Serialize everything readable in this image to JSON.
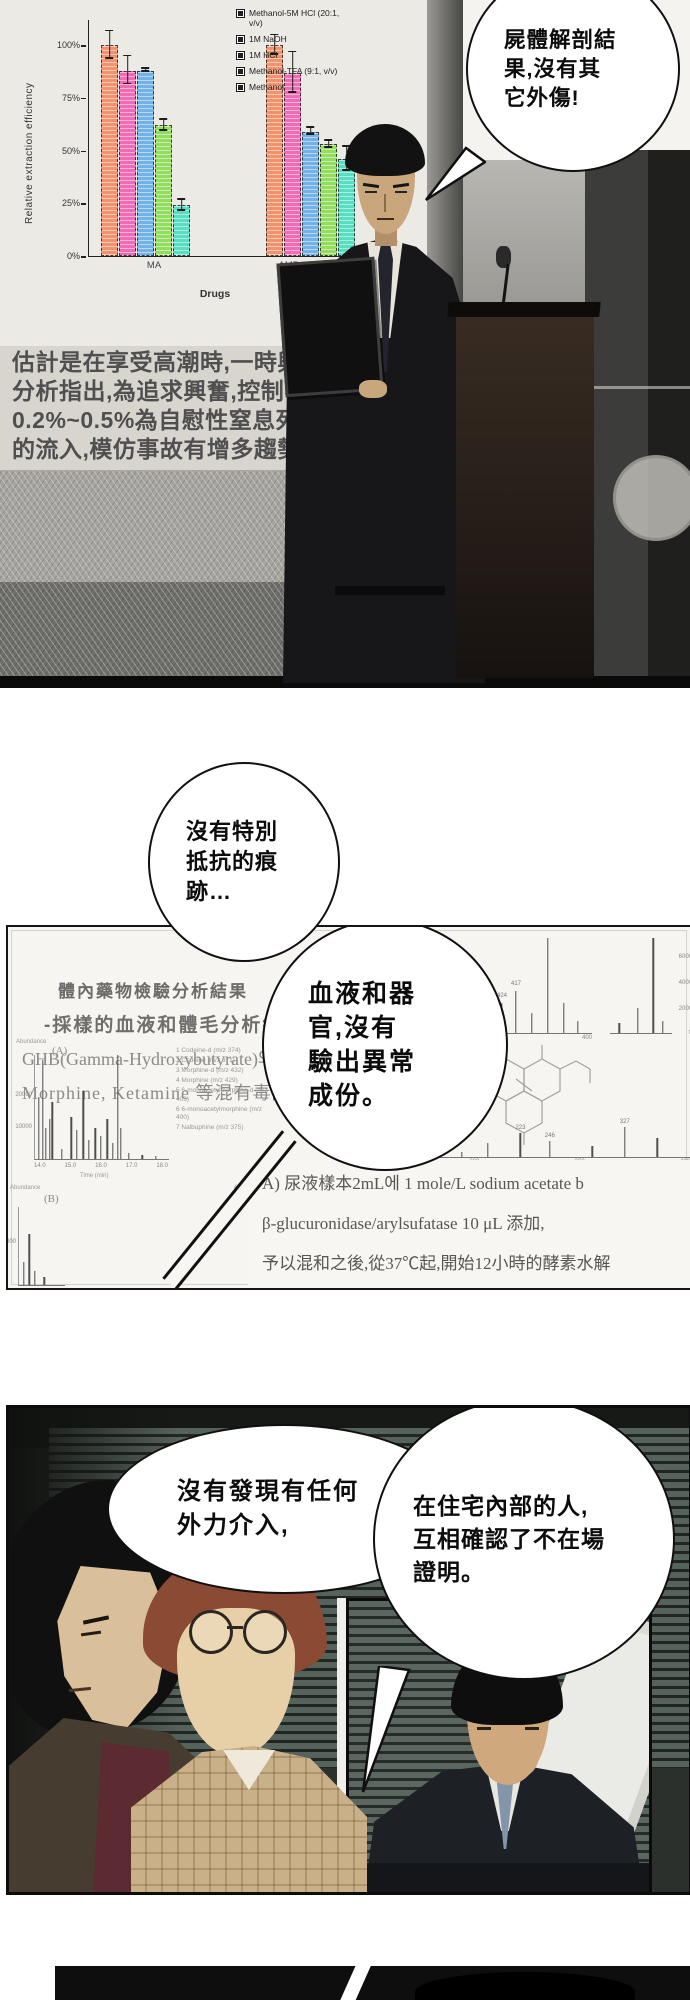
{
  "panel1": {
    "bubble_lines": [
      "屍體解剖結",
      "果,沒有其",
      "它外傷!"
    ],
    "caption_lines": [
      "估計是在享受高潮時,一時興奮而死,",
      "分析指出,為追求興奮,控制不當,導致",
      "0.2%~0.5%為自慰性窒息死,",
      "的流入,模仿事故有增多趨勢"
    ]
  },
  "chart_data": [
    {
      "type": "bar",
      "title": "",
      "ylabel": "Relative extraction efficiency",
      "xlabel": "Drugs",
      "categories": [
        "MA",
        "AMP"
      ],
      "ylim": [
        0,
        112
      ],
      "yticks": [
        {
          "label": "100%",
          "p": 89.3
        },
        {
          "label": "75%",
          "p": 67.0
        },
        {
          "label": "50%",
          "p": 44.6
        },
        {
          "label": "25%",
          "p": 22.3
        },
        {
          "label": "0%",
          "p": 0
        }
      ],
      "legend_position": "top-right",
      "series": [
        {
          "name": "Methanol-5M HCl (20:1, v/v)",
          "color": "#f2926c",
          "values": [
            100,
            100
          ],
          "errors": [
            7,
            5
          ]
        },
        {
          "name": "1M NaOH",
          "color": "#f06ab4",
          "values": [
            88,
            87
          ],
          "errors": [
            7,
            10
          ]
        },
        {
          "name": "1M HCl",
          "color": "#72b2e6",
          "values": [
            88,
            59
          ],
          "errors": [
            1,
            2
          ]
        },
        {
          "name": "Methanol-TFA (9:1, v/v)",
          "color": "#92dc5e",
          "values": [
            62,
            53
          ],
          "errors": [
            3,
            2
          ]
        },
        {
          "name": "Methanol",
          "color": "#57ddc1",
          "values": [
            24,
            46
          ],
          "errors": [
            3,
            6
          ]
        }
      ]
    },
    {
      "type": "line",
      "label": "(A)",
      "ylabel": "Abundance",
      "xlabel": "Time (min)",
      "xticks": [
        "14.0",
        "15.0",
        "16.0",
        "17.0",
        "18.0"
      ],
      "yticks": [
        {
          "label": "20000",
          "p": 62
        },
        {
          "label": "10000",
          "p": 31
        }
      ],
      "peaks": [
        [
          3,
          60
        ],
        [
          6,
          95
        ],
        [
          8,
          30
        ],
        [
          11,
          38
        ],
        [
          13,
          55
        ],
        [
          20,
          10
        ],
        [
          27,
          40
        ],
        [
          31,
          28
        ],
        [
          36,
          65
        ],
        [
          40,
          18
        ],
        [
          45,
          30
        ],
        [
          49,
          22
        ],
        [
          54,
          38
        ],
        [
          58,
          15
        ],
        [
          62,
          100
        ],
        [
          64,
          30
        ],
        [
          70,
          6
        ],
        [
          80,
          4
        ],
        [
          90,
          3
        ]
      ],
      "legend": [
        "1 Codeine-d (m/z 374)",
        "2 Codeine (m/z 371)",
        "3 Morphine-d (m/z 432)",
        "4 Morphine (m/z 429)",
        "5 6-monoacetylmorphine-d (m/z 403)",
        "6 6-monoacetylmorphine (m/z 400)",
        "7 Nalbuphine (m/z 375)"
      ]
    }
  ],
  "panel2": {
    "bubble1_lines": [
      "沒有特別",
      "抵抗的痕",
      "跡…"
    ],
    "bubble2_lines": [
      "血液和器",
      "官,沒有",
      "驗出異常",
      "成份。"
    ],
    "report_lines": [
      "體內藥物檢驗分析結果",
      "-採樣的血液和體毛分析結果",
      "GHB(Gamma-Hydroxybutyrate)와 Dextro",
      "Morphine, Ketamine 等混有毒品成分"
    ],
    "procedure_lines": [
      "A) 尿液樣本2mL에 1 mole/L sodium acetate b",
      "β-glucuronidase/arylsufatase 10 μL 添加,",
      "予以混和之後,從37℃起,開始12小時的酵素水解"
    ],
    "spec_labels": {
      "b": "(B)",
      "c": "(C)",
      "d": "(D)"
    },
    "spectra": {
      "c": {
        "xticks": [
          "300",
          "400"
        ],
        "peaks": [
          [
            2,
            50,
            ""
          ],
          [
            6,
            14,
            ""
          ],
          [
            12,
            22,
            "327"
          ],
          [
            18,
            10,
            "343"
          ],
          [
            24,
            16,
            ""
          ],
          [
            30,
            26,
            "371"
          ],
          [
            40,
            12,
            ""
          ],
          [
            55,
            30,
            "424"
          ],
          [
            62,
            42,
            "417"
          ],
          [
            70,
            20,
            ""
          ],
          [
            78,
            95,
            ""
          ],
          [
            86,
            30,
            ""
          ],
          [
            93,
            12,
            ""
          ]
        ]
      },
      "e": {
        "yticks": [
          {
            "label": "6000",
            "p": 75
          },
          {
            "label": "4000",
            "p": 50
          },
          {
            "label": "2000",
            "p": 25
          },
          {
            "label": "0",
            "p": 2
          }
        ],
        "peaks": [
          [
            15,
            10
          ],
          [
            45,
            25
          ],
          [
            70,
            95
          ],
          [
            85,
            12
          ]
        ]
      },
      "f": {
        "xticks": [
          "100",
          "200",
          "300",
          "400"
        ],
        "peaks": [
          [
            4,
            22
          ],
          [
            9,
            60
          ],
          [
            15,
            14
          ],
          [
            22,
            34
          ],
          [
            30,
            10
          ],
          [
            38,
            26
          ],
          [
            48,
            44,
            "223"
          ],
          [
            57,
            30,
            "246"
          ],
          [
            70,
            20
          ],
          [
            80,
            55,
            "327"
          ],
          [
            90,
            35
          ]
        ]
      },
      "b": {
        "yticks": [
          {
            "label": "20000",
            "p": 55
          }
        ],
        "peaks": [
          [
            10,
            30
          ],
          [
            22,
            65
          ],
          [
            35,
            18
          ],
          [
            55,
            10
          ]
        ]
      }
    }
  },
  "panel3": {
    "bubble1_lines": [
      "沒有發現有任何",
      "外力介入,"
    ],
    "bubble2_lines": [
      "在住宅內部的人,",
      "互相確認了不在場",
      "證明。"
    ]
  }
}
